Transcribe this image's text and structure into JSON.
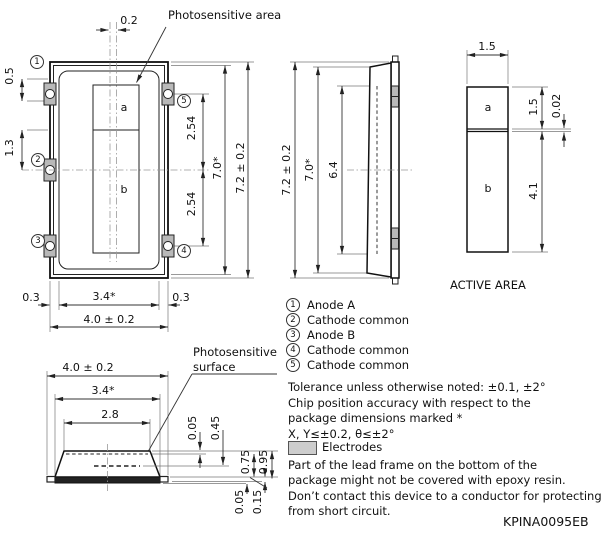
{
  "drawing_code": "KPINA0095EB",
  "front_view": {
    "annotation": "Photosensitive area",
    "chip_labels": {
      "a": "a",
      "b": "b"
    },
    "dims": {
      "offset_top": "0.2",
      "left_top": "0.5",
      "left_mid": "1.3",
      "right_upper": "2.54",
      "right_lower": "2.54",
      "height_inner": "7.0*",
      "height_outer": "7.2 ± 0.2",
      "bottom_left": "0.3",
      "bottom_inner": "3.4*",
      "bottom_right": "0.3",
      "bottom_outer": "4.0 ± 0.2"
    }
  },
  "side_view": {
    "dims": {
      "height_outer": "7.2 ± 0.2",
      "height_inner": "7.0*",
      "window": "6.4"
    }
  },
  "active_area_view": {
    "caption": "ACTIVE AREA",
    "labels": {
      "a": "a",
      "b": "b"
    },
    "dims": {
      "width": "1.5",
      "a_height": "1.5",
      "gap": "0.02",
      "b_height": "4.1"
    }
  },
  "bottom_view": {
    "annotation_line1": "Photosensitive",
    "annotation_line2": "surface",
    "dims": {
      "outer": "4.0 ± 0.2",
      "inner": "3.4*",
      "window": "2.8",
      "surf_offset": "0.05",
      "surf_depth": "0.45",
      "body_height": "0.75",
      "total_height": "0.95",
      "foot_a": "0.05",
      "foot_b": "0.15"
    }
  },
  "pins": [
    {
      "num": "1",
      "label": "Anode A"
    },
    {
      "num": "2",
      "label": "Cathode common"
    },
    {
      "num": "3",
      "label": "Anode B"
    },
    {
      "num": "4",
      "label": "Cathode common"
    },
    {
      "num": "5",
      "label": "Cathode common"
    }
  ],
  "notes": {
    "lines": [
      "Tolerance unless otherwise noted: ±0.1, ±2°",
      "Chip position accuracy with respect to the",
      "package dimensions marked *",
      "X, Y≤±0.2, θ≤±2°"
    ],
    "electrodes_label": "Electrodes",
    "lines2": [
      "Part of the lead frame on the bottom of the",
      "package might not be covered with epoxy resin.",
      "Don’t contact this device to a conductor for protecting",
      "from short circuit."
    ]
  },
  "colors": {
    "electrode_gray": "#b9b9b9",
    "swatch_gray": "#cdcdcd",
    "line": "#111111"
  }
}
